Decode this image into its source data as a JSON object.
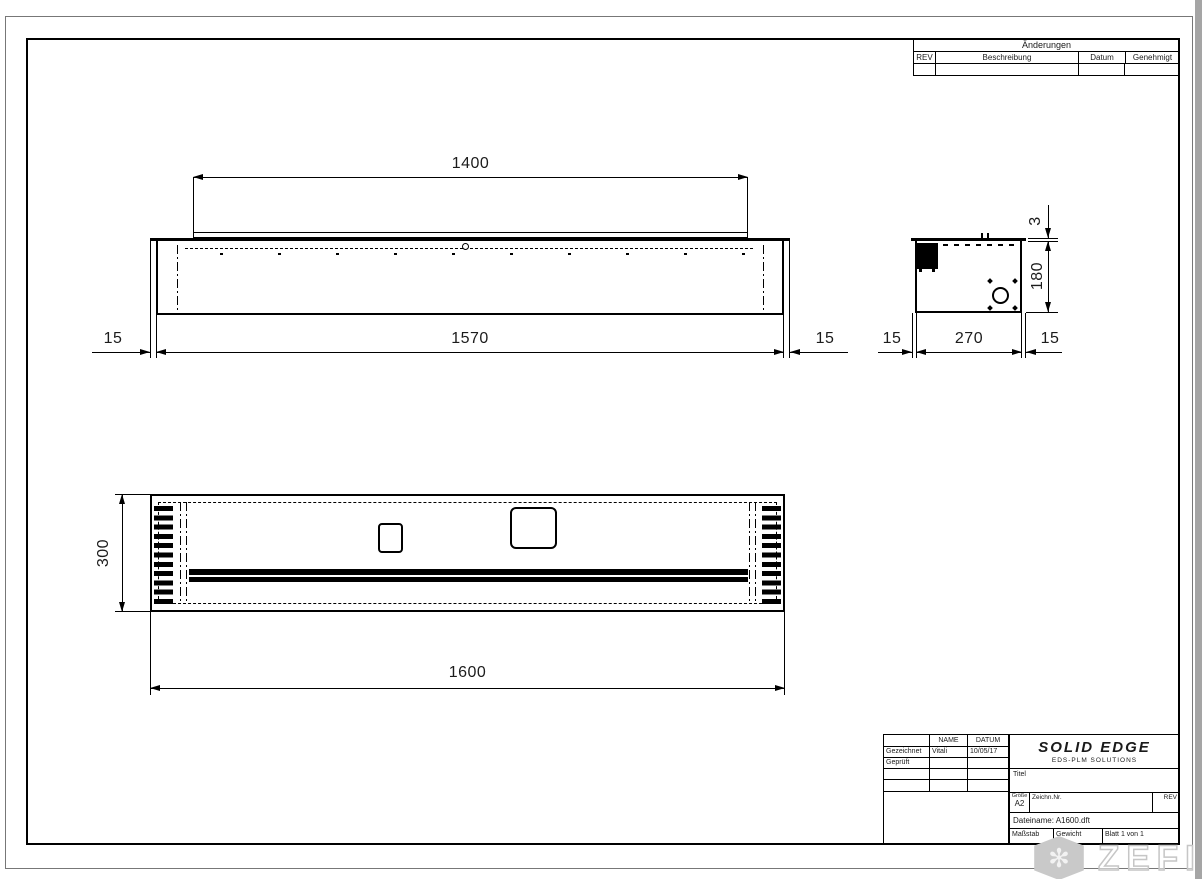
{
  "revision_table": {
    "title": "Änderungen",
    "columns": {
      "rev": "REV",
      "description": "Beschreibung",
      "date": "Datum",
      "approved": "Genehmigt"
    }
  },
  "title_block": {
    "header_name": "NAME",
    "header_date": "DATUM",
    "drawn_label": "Gezeichnet",
    "drawn_name": "Vitali",
    "drawn_date": "10/05/17",
    "checked_label": "Geprüft",
    "logo_title": "SOLID EDGE",
    "logo_subtitle": "EDS-PLM SOLUTIONS",
    "title_label": "Titel",
    "size_label": "Größe",
    "size_value": "A2",
    "drawing_no_label": "Zeichn.Nr.",
    "rev_label": "REV",
    "filename": "Dateiname: A1600.dft",
    "scale_label": "Maßstab",
    "weight_label": "Gewicht",
    "sheet_label": "Blatt 1 von 1"
  },
  "views": {
    "front": {
      "dim_top_lip": "1400",
      "dim_inner_width": "1570",
      "dim_flange_left": "15",
      "dim_flange_right": "15"
    },
    "side": {
      "dim_width": "270",
      "dim_flange_left": "15",
      "dim_flange_right": "15",
      "dim_height": "180",
      "dim_top_plate": "3"
    },
    "top": {
      "dim_depth": "300",
      "dim_overall_length": "1600"
    }
  },
  "watermark": {
    "text": "ZEFIRE",
    "icon_glyph": "✻"
  },
  "colors": {
    "line": "#000000",
    "paper": "#ffffff",
    "watermark": "#c9c9c9",
    "page_edge": "#a5a5a5"
  }
}
